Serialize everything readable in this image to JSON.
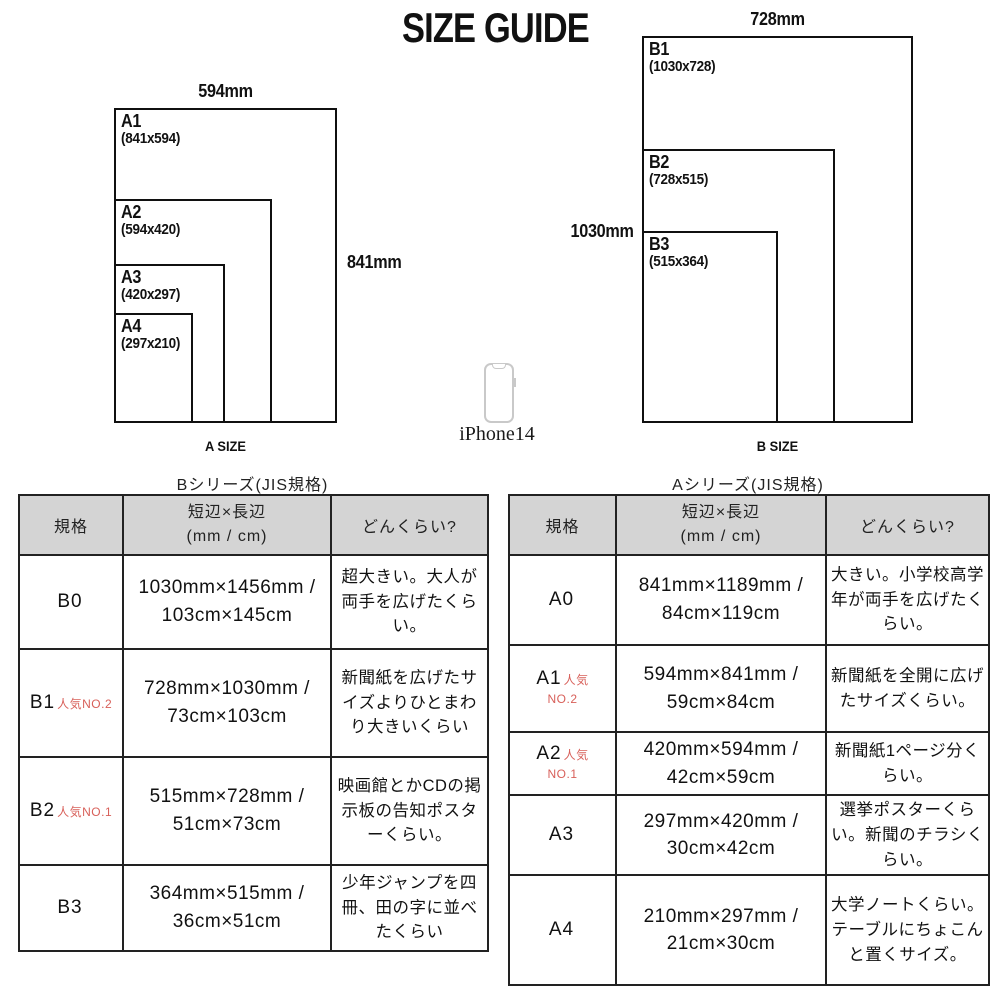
{
  "title": "SIZE GUIDE",
  "colors": {
    "accent_red": "#d8605a",
    "table_header_gray": "#d4d4d4",
    "line_black": "#101010"
  },
  "phone": {
    "icon": "smartphone-outline",
    "label": "iPhone14"
  },
  "diagram_a": {
    "caption": "A SIZE",
    "top_label": "594mm",
    "side_label": "841mm",
    "sheets": [
      {
        "name": "A1",
        "dims": "(841x594)"
      },
      {
        "name": "A2",
        "dims": "(594x420)"
      },
      {
        "name": "A3",
        "dims": "(420x297)"
      },
      {
        "name": "A4",
        "dims": "(297x210)"
      }
    ]
  },
  "diagram_b": {
    "caption": "B SIZE",
    "top_label": "728mm",
    "side_label": "1030mm",
    "sheets": [
      {
        "name": "B1",
        "dims": "(1030x728)"
      },
      {
        "name": "B2",
        "dims": "(728x515)"
      },
      {
        "name": "B3",
        "dims": "(515x364)"
      }
    ]
  },
  "table_b": {
    "title": "Bシリーズ(JIS規格)",
    "headers": {
      "spec": "規格",
      "size_line1": "短辺×長辺",
      "size_line2": "(mm / cm)",
      "guide": "どんくらい?"
    },
    "rows": [
      {
        "spec": "B0",
        "badge_inline": "",
        "badge_below": "",
        "size": "1030mm×1456mm / 103cm×145cm",
        "guide": "超大きい。大人が両手を広げたくらい。"
      },
      {
        "spec": "B1",
        "badge_inline": "人気NO.2",
        "badge_below": "",
        "size": "728mm×1030mm / 73cm×103cm",
        "guide": "新聞紙を広げたサイズよりひとまわり大きいくらい"
      },
      {
        "spec": "B2",
        "badge_inline": "人気NO.1",
        "badge_below": "",
        "size": "515mm×728mm / 51cm×73cm",
        "guide": "映画館とかCDの掲示板の告知ポスターくらい。"
      },
      {
        "spec": "B3",
        "badge_inline": "",
        "badge_below": "",
        "size": "364mm×515mm / 36cm×51cm",
        "guide": "少年ジャンプを四冊、田の字に並べたくらい"
      }
    ]
  },
  "table_a": {
    "title": "Aシリーズ(JIS規格)",
    "headers": {
      "spec": "規格",
      "size_line1": "短辺×長辺",
      "size_line2": "(mm / cm)",
      "guide": "どんくらい?"
    },
    "rows": [
      {
        "spec": "A0",
        "badge_inline": "",
        "badge_below": "",
        "size": "841mm×1189mm / 84cm×119cm",
        "guide": "大きい。小学校高学年が両手を広げたくらい。"
      },
      {
        "spec": "A1",
        "badge_inline": "人気",
        "badge_below": "NO.2",
        "size": "594mm×841mm / 59cm×84cm",
        "guide": "新聞紙を全開に広げたサイズくらい。"
      },
      {
        "spec": "A2",
        "badge_inline": "人気",
        "badge_below": "NO.1",
        "size": "420mm×594mm / 42cm×59cm",
        "guide": "新聞紙1ページ分くらい。"
      },
      {
        "spec": "A3",
        "badge_inline": "",
        "badge_below": "",
        "size": "297mm×420mm / 30cm×42cm",
        "guide": "選挙ポスターくらい。新聞のチラシくらい。"
      },
      {
        "spec": "A4",
        "badge_inline": "",
        "badge_below": "",
        "size": "210mm×297mm / 21cm×30cm",
        "guide": "大学ノートくらい。テーブルにちょこんと置くサイズ。"
      }
    ]
  }
}
